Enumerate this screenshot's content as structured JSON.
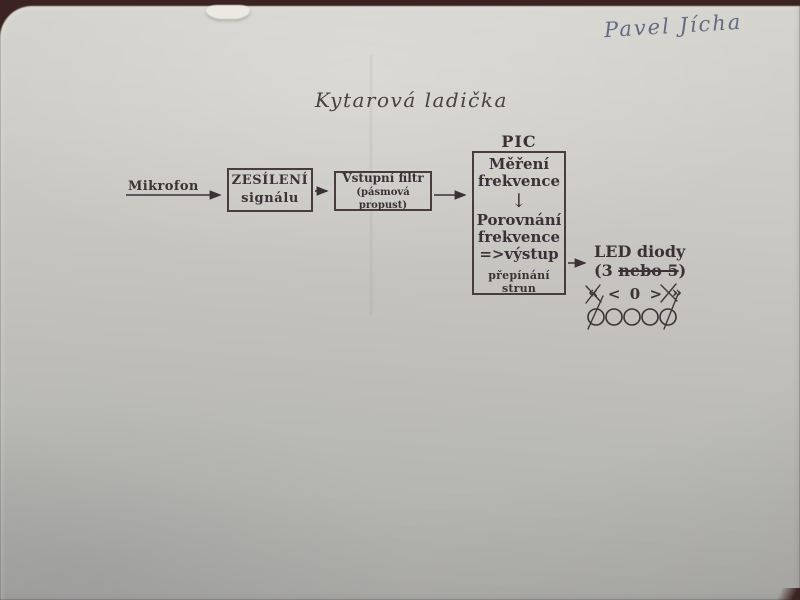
{
  "photo": {
    "table_color": "#3b2321",
    "paper_color": "#c6c5c1",
    "ink_color": "#3b3137",
    "pen_color": "#4e5974"
  },
  "handwritten_name": "Pavel Jícha",
  "title": "Kytarová ladička",
  "diagram": {
    "microphone_label": "Mikrofon",
    "amplifier_block": {
      "line1": "ZESÍLENÍ",
      "line2": "signálu"
    },
    "filter_block": {
      "line1": "Vstupní filtr",
      "line2": "(pásmová propust)"
    },
    "pic_block": {
      "label": "PIC",
      "step1_line1": "Měření",
      "step1_line2": "frekvence",
      "down_arrow": "↓",
      "step2_line1": "Porovnání",
      "step2_line2": "frekvence",
      "step2_line3": "=>výstup",
      "footer": "přepínání strun"
    },
    "output": {
      "line1": "LED diody",
      "count_prefix": "(3 ",
      "count_struck": "nebo 5",
      "count_suffix": ")",
      "symbols": [
        "«",
        "<",
        "0",
        ">",
        "»"
      ],
      "led_count": 5
    }
  }
}
